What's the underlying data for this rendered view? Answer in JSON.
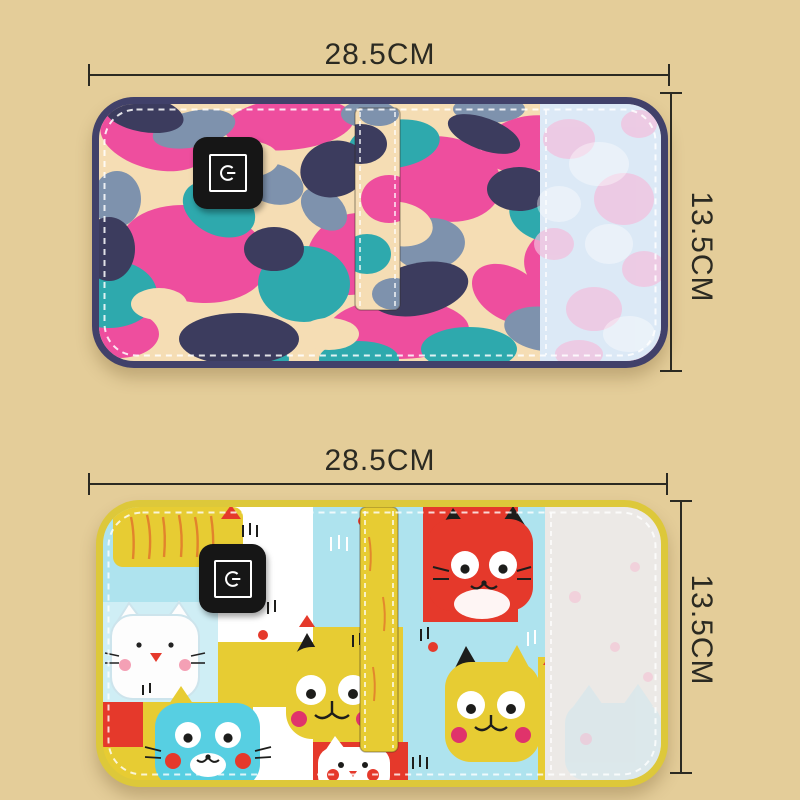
{
  "scene": {
    "description": "Two USB heated baby bottle warmer bags laid flat with size annotations",
    "background_color": "#e4cd99"
  },
  "annotation": {
    "line_color": "#2b2a22",
    "text_color": "#2b2a22"
  },
  "products": [
    {
      "id": "camouflage-warmer-bag",
      "pattern": "pink-teal-camouflage",
      "width_label": "28.5CM",
      "height_label": "13.5CM",
      "trim_color": "#41416a",
      "pattern_colors": {
        "cream": "#f5ddb4",
        "pink": "#ee4e9e",
        "teal": "#2ea9ad",
        "navy": "#3c3c5e",
        "slate": "#7e92ad",
        "velcro": "#dce9f6"
      },
      "power_button_icon": "power-icon"
    },
    {
      "id": "cat-print-warmer-bag",
      "pattern": "cartoon-cats",
      "width_label": "28.5CM",
      "height_label": "13.5CM",
      "trim_color": "#ddc83a",
      "pattern_colors": {
        "yellow": "#e7cc33",
        "blue": "#aee3ee",
        "red": "#e5392b",
        "white": "#ffffff",
        "velcro": "#ece9e6"
      },
      "power_button_icon": "power-icon"
    }
  ]
}
